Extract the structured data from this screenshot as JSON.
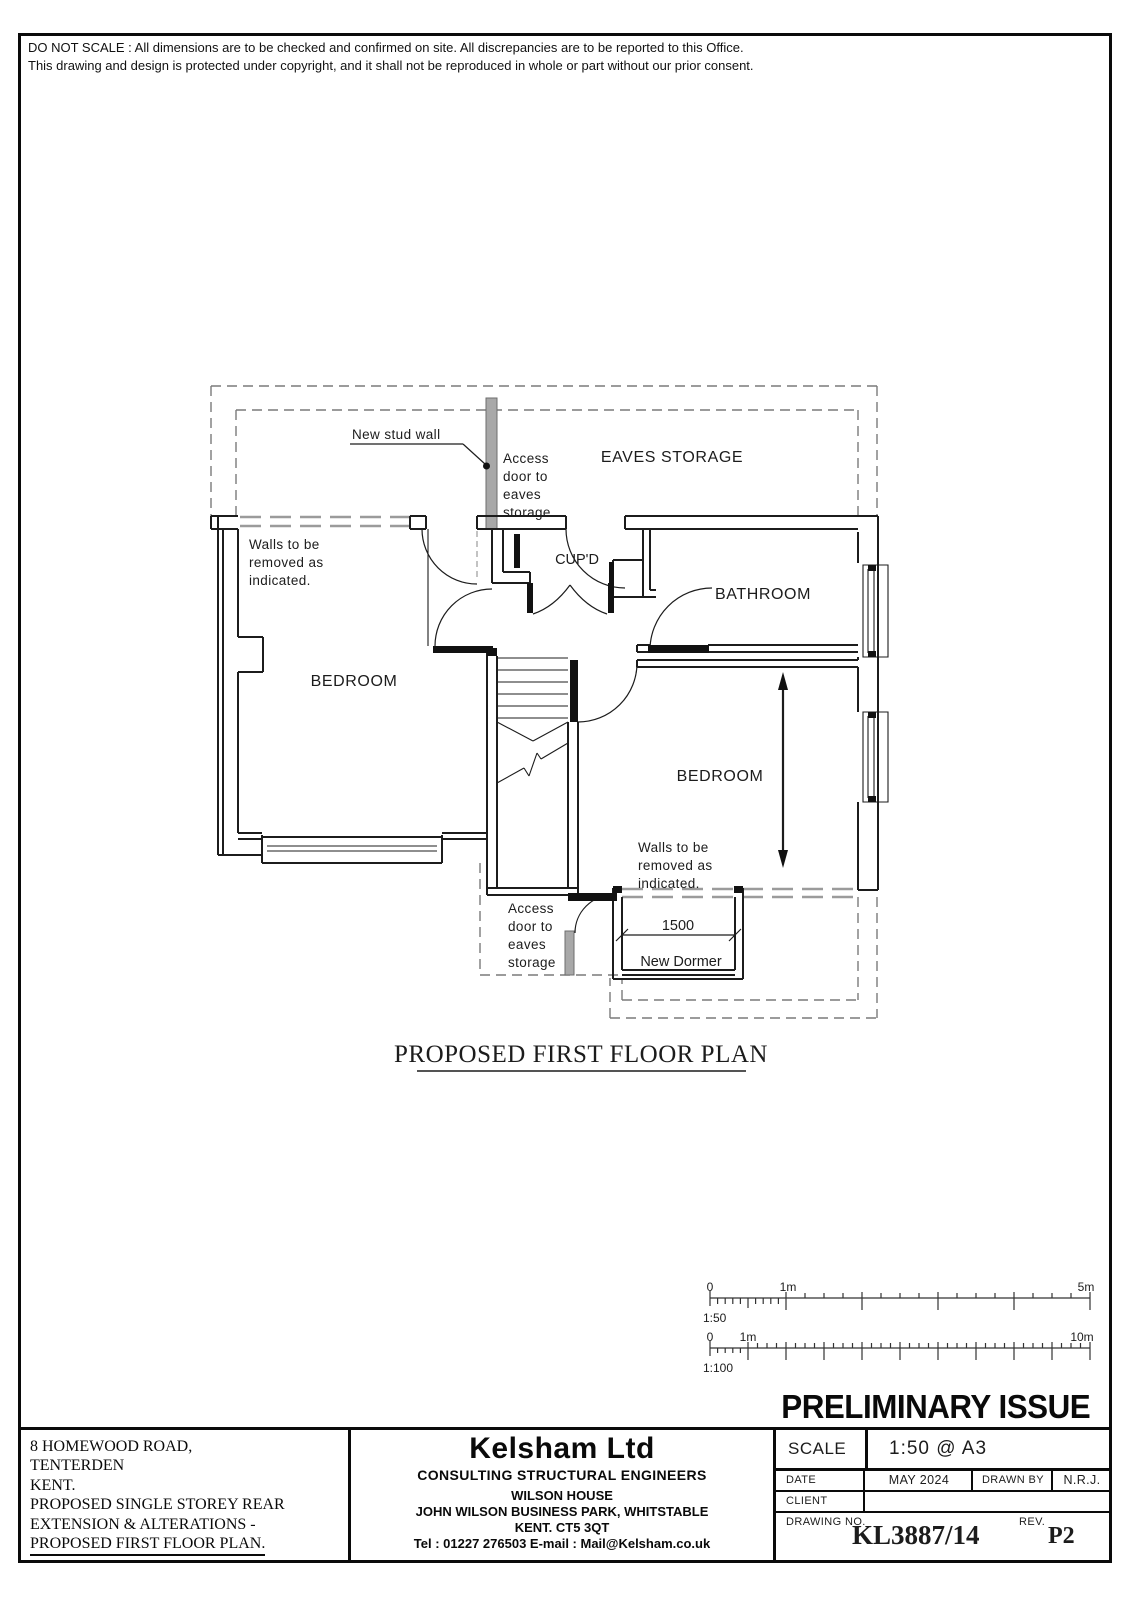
{
  "page": {
    "disclaimer_line1": "DO NOT SCALE : All dimensions are to be checked and confirmed on site. All discrepancies are to be reported to this Office.",
    "disclaimer_line2": "This drawing and design is protected under copyright, and it shall not be reproduced in whole or part without our prior consent."
  },
  "plan": {
    "title": "PROPOSED FIRST FLOOR PLAN",
    "labels": {
      "new_stud_wall": "New stud wall",
      "access_door_eaves": [
        "Access",
        "door to",
        "eaves",
        "storage"
      ],
      "eaves_storage": "EAVES STORAGE",
      "cupboard": "CUP'D",
      "bathroom": "BATHROOM",
      "bedroom": "BEDROOM",
      "walls_removed": [
        "Walls to be",
        "removed as",
        "indicated."
      ],
      "dormer_width": "1500",
      "new_dormer": "New Dormer"
    }
  },
  "scale_bars": {
    "s50": {
      "zero": "0",
      "one": "1m",
      "five": "5m",
      "name": "1:50"
    },
    "s100": {
      "zero": "0",
      "one": "1m",
      "ten": "10m",
      "name": "1:100"
    }
  },
  "stamp": "PRELIMINARY ISSUE",
  "title_block": {
    "project": [
      "8 HOMEWOOD ROAD,",
      "TENTERDEN",
      "KENT.",
      "PROPOSED SINGLE STOREY REAR",
      "EXTENSION & ALTERATIONS -",
      "PROPOSED FIRST FLOOR PLAN."
    ],
    "company": {
      "name": "Kelsham Ltd",
      "profession": "CONSULTING STRUCTURAL ENGINEERS",
      "address": [
        "WILSON HOUSE",
        "JOHN WILSON BUSINESS PARK, WHITSTABLE",
        "KENT. CT5 3QT"
      ],
      "contact": "Tel : 01227 276503  E-mail : Mail@Kelsham.co.uk"
    },
    "fields": {
      "scale_label": "SCALE",
      "scale_value": "1:50 @ A3",
      "date_label": "DATE",
      "date_value": "MAY 2024",
      "drawn_by_label": "DRAWN BY",
      "drawn_by_value": "N.R.J.",
      "client_label": "CLIENT",
      "client_value": "",
      "drawing_no_label": "DRAWING NO.",
      "drawing_no_value": "KL3887/14",
      "rev_label": "REV.",
      "rev_value": "P2"
    }
  },
  "colors": {
    "ink": "#1c1c1c",
    "removed_wall_gray": "#9b9b9b",
    "roof_dash_gray": "#7a7a7a",
    "paper": "#ffffff"
  }
}
